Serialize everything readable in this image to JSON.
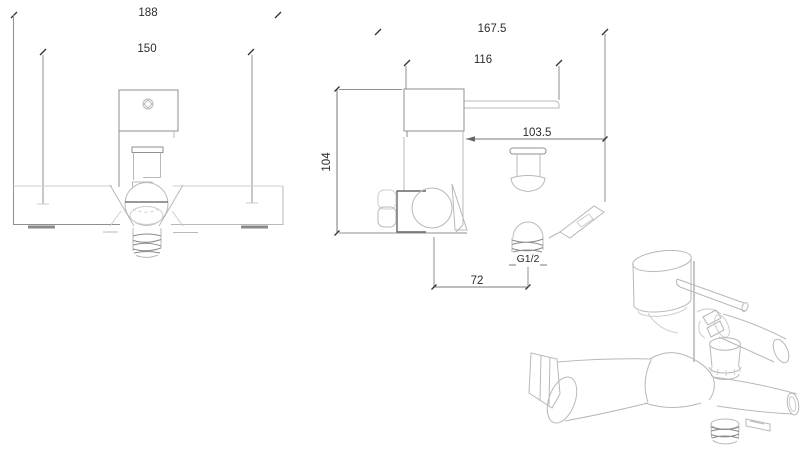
{
  "page": {
    "description": "Technical dimension drawing of a wall-mounted single-lever bath mixer faucet with front view, side view and 3D perspective view",
    "background": "#ffffff"
  },
  "views": {
    "front": {
      "dim_overall_width": "188",
      "dim_mounting_centers": "150"
    },
    "side": {
      "dim_overall_depth": "167.5",
      "dim_handle_reach": "116",
      "dim_diverter_knob_depth": "103.5",
      "dim_body_height": "104",
      "dim_outlet_offset": "72",
      "thread_label": "G1/2"
    },
    "perspective": {}
  },
  "colors": {
    "outline_light": "#b8b8b8",
    "outline_medium": "#8f8f8f",
    "dimension_line": "#7a7a7a",
    "dimension_text": "#2b2b2b",
    "background": "#ffffff"
  }
}
